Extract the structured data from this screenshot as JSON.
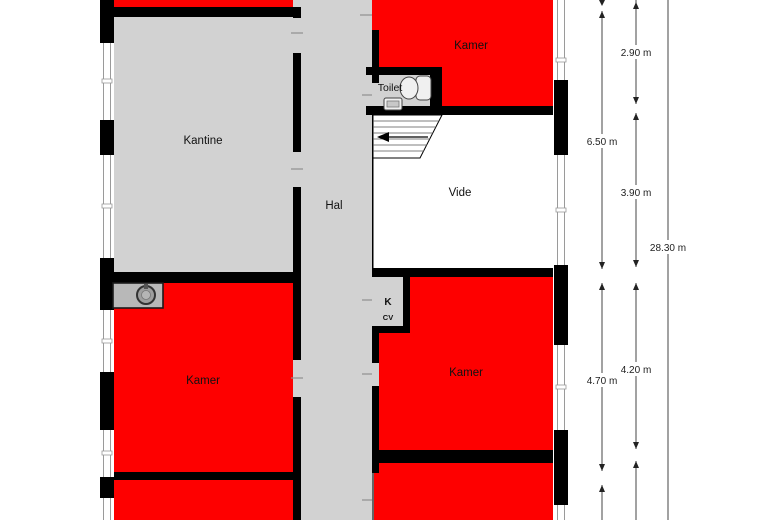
{
  "plan_title": "floor-plan",
  "rooms": {
    "kantine": "Kantine",
    "hal": "Hal",
    "toilet": "Toilet",
    "vide": "Vide",
    "kamer_top_right": "Kamer",
    "kamer_bottom_left": "Kamer",
    "kamer_bottom_right": "Kamer",
    "closet_k": "K",
    "closet_cv": "CV"
  },
  "dimensions": {
    "seg_right_top": "2.90 m",
    "seg_left_mid": "6.50 m",
    "seg_right_mid": "3.90 m",
    "total_height": "28.30 m",
    "seg_left_bottom": "4.70 m",
    "seg_right_bottom": "4.20 m"
  },
  "colors": {
    "highlight_room": "#fe0000",
    "gray_room": "#d2d2d2",
    "wall": "#000000",
    "dimension_line": "#444444"
  }
}
